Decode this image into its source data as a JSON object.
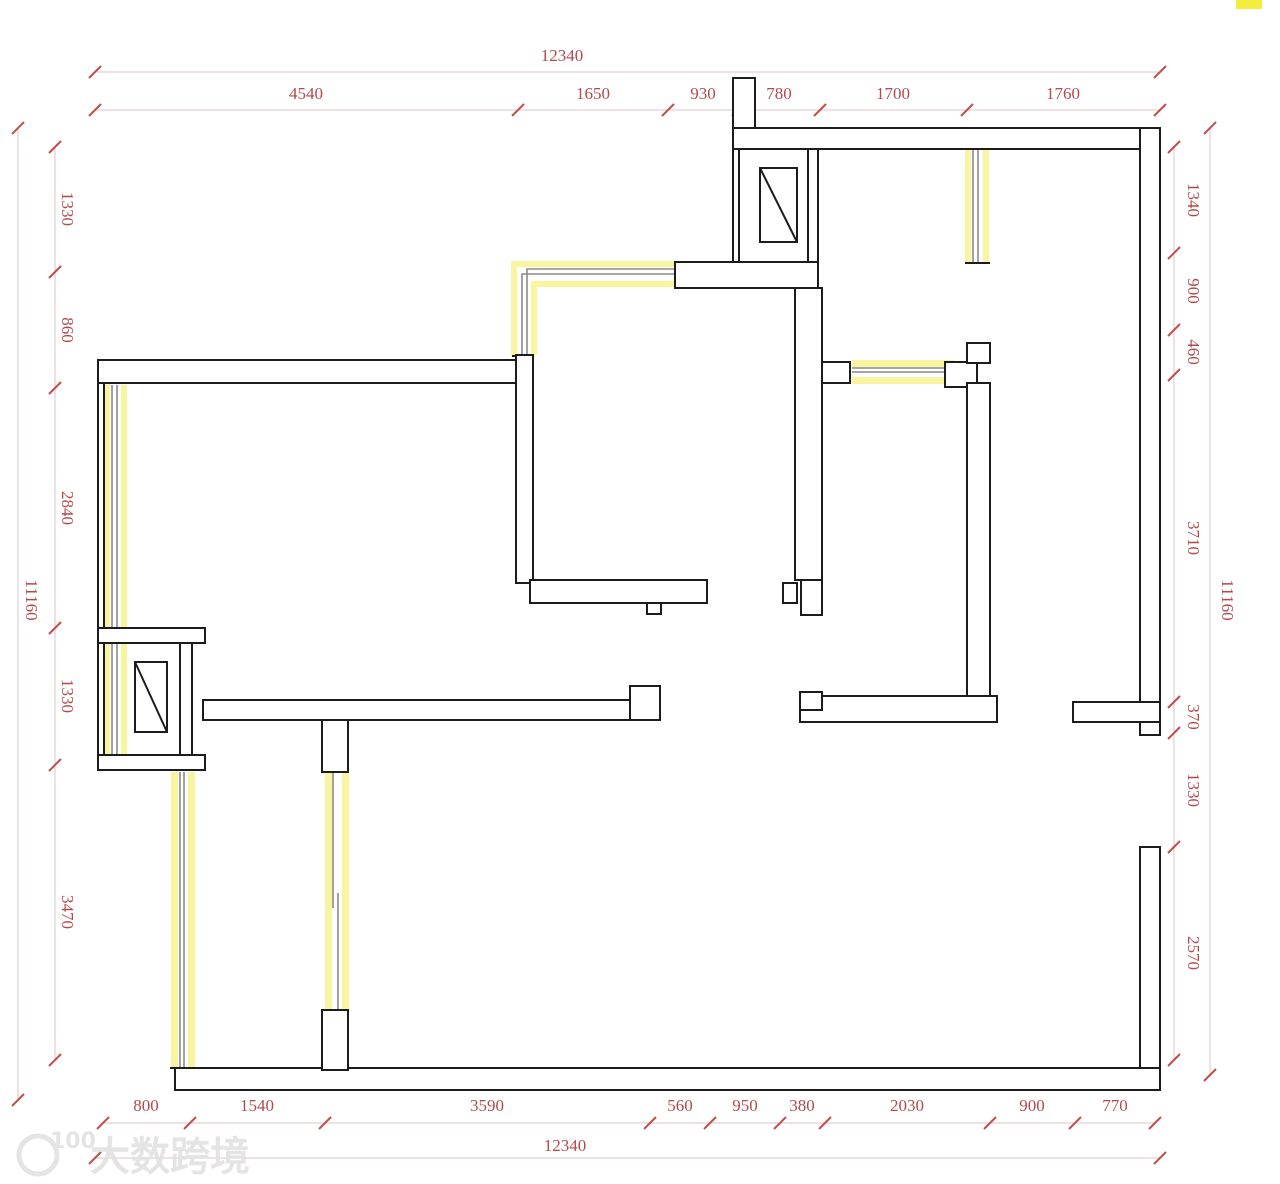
{
  "drawing": {
    "type": "floor-plan",
    "units": "mm",
    "colors": {
      "wall": "#1c1c1c",
      "window_glass": "#8a8a8a",
      "window_highlight": "#f8f4a0",
      "dimension_text": "#b24a4c",
      "dimension_tick": "#c0504d",
      "dimension_line": "#dcc3c3",
      "background": "#ffffff",
      "corner_mark": "#f3ee3e",
      "watermark": "#e0e0e0"
    }
  },
  "dimensions": {
    "top": {
      "overall": "12340",
      "segments": [
        "4540",
        "1650",
        "930",
        "780",
        "1700",
        "1760"
      ]
    },
    "bottom": {
      "overall": "12340",
      "segments": [
        "800",
        "1540",
        "3590",
        "560",
        "950",
        "380",
        "2030",
        "900",
        "770"
      ]
    },
    "left": {
      "overall": "11160",
      "segments": [
        "1330",
        "860",
        "2840",
        "1330",
        "3470"
      ]
    },
    "right": {
      "overall": "11160",
      "segments": [
        "1340",
        "900",
        "460",
        "3710",
        "370",
        "1330",
        "2570"
      ]
    }
  },
  "watermark": {
    "text": "大数跨境",
    "logo": "100"
  }
}
